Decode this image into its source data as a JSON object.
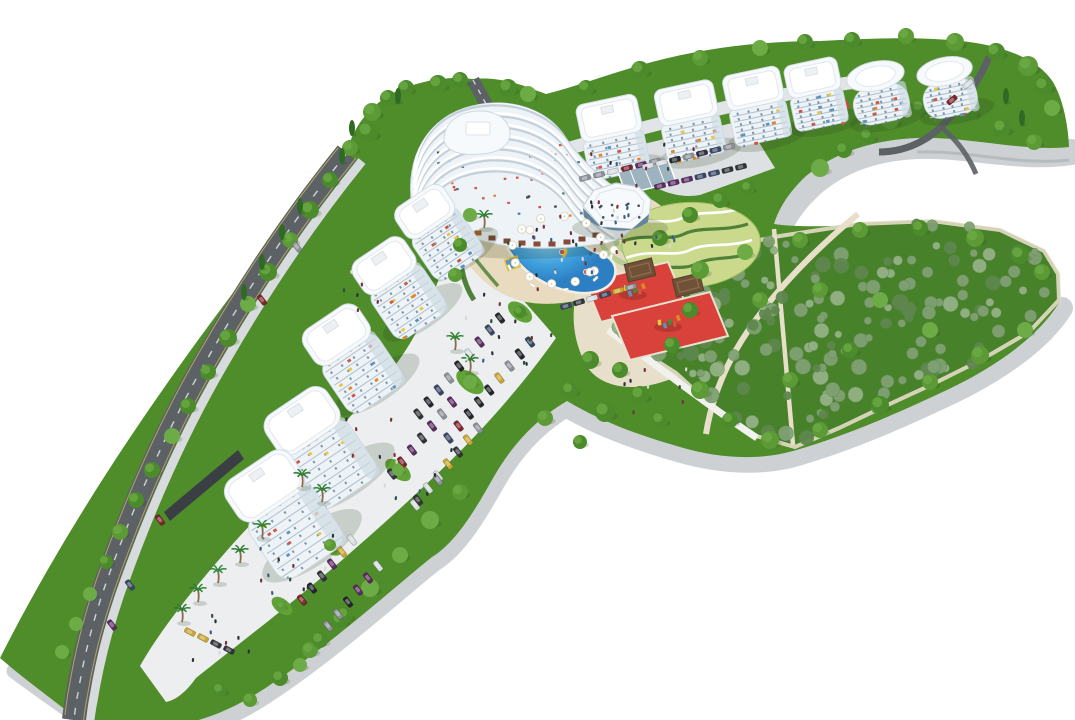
{
  "scene": {
    "type": "Aerial 3D architectural rendering of a residential resort complex master plan",
    "elements": [
      {
        "name": "terraced-landmark-apartment-building",
        "count": 1
      },
      {
        "name": "curved-apartment-tower-left-row",
        "count": 5
      },
      {
        "name": "apartment-block-upper-row",
        "count": 6
      },
      {
        "name": "round-clubhouse-with-roof-terrace",
        "count": 1
      },
      {
        "name": "kidney-shaped-swimming-pool",
        "count": 1
      },
      {
        "name": "kids-pool",
        "count": 1
      },
      {
        "name": "water-slide",
        "count": 1
      },
      {
        "name": "inflatable-bouncy-castle",
        "count": 1
      },
      {
        "name": "red-playground-court",
        "count": 2
      },
      {
        "name": "wooden-pergola",
        "count": 2
      },
      {
        "name": "amphitheater-steps",
        "count": 1
      },
      {
        "name": "ornamental-hedge-garden",
        "count": 1
      },
      {
        "name": "central-park-with-shrubs",
        "count": 1
      },
      {
        "name": "parking-lot",
        "count": 4
      },
      {
        "name": "palm-tree",
        "count": 10
      },
      {
        "name": "access-road",
        "count": 3
      },
      {
        "name": "perimeter-retaining-wall",
        "count": 1
      }
    ]
  },
  "palette": {
    "background": "#ffffff",
    "grass": "#4f8c2a",
    "grass_light": "#61a237",
    "grass_dark": "#3c741f",
    "park_green": "#47822a",
    "shrub": "#80a173",
    "shrub_light": "#93b285",
    "shrub_dark": "#5f874f",
    "tree": "#4b8b2b",
    "tree_light": "#6cab45",
    "tree_dark": "#2f6a22",
    "wall": "#cdd1d3",
    "wall_dark": "#9fa5a8",
    "dark_wall": "#3a3f43",
    "road": "#5c6165",
    "road_mark": "#c8b465",
    "plaza": "#eceef0",
    "plaza_shade": "#dde1e3",
    "deck": "#e9dbbf",
    "path_cream": "#e7dfc9",
    "path_white": "#f1f1ee",
    "pool": "#3f9fdd",
    "pool_light": "#8ed0f0",
    "pool_deep": "#2c7fc2",
    "court_red": "#d8423a",
    "garden_light": "#cbd98c",
    "hedge": "#4f8238",
    "building_white": "#f7fafc",
    "building_shade": "#dfe7ed",
    "building_stripe": "#b4c3d0",
    "window": "#54788f",
    "glass": "#64859b",
    "pergola": "#6e5137",
    "accent_orange": "#e2862c",
    "accent_yellow": "#e9c83f",
    "accent_red": "#cf5544",
    "accent_blue": "#5a94c0",
    "palm_frond": "#2f8a38",
    "palm_trunk": "#8a6b4a",
    "shadow": "rgba(40,60,30,0.18)",
    "car_colors": [
      "#23262b",
      "#7e242b",
      "#caa52e",
      "#d7dce0",
      "#394664",
      "#5c2a62",
      "#8c9197",
      "#30343a"
    ],
    "people_colors": [
      "#2c3137",
      "#7a3434",
      "#d8d8d6",
      "#3c5c82",
      "#74323f",
      "#2f4f38"
    ]
  }
}
